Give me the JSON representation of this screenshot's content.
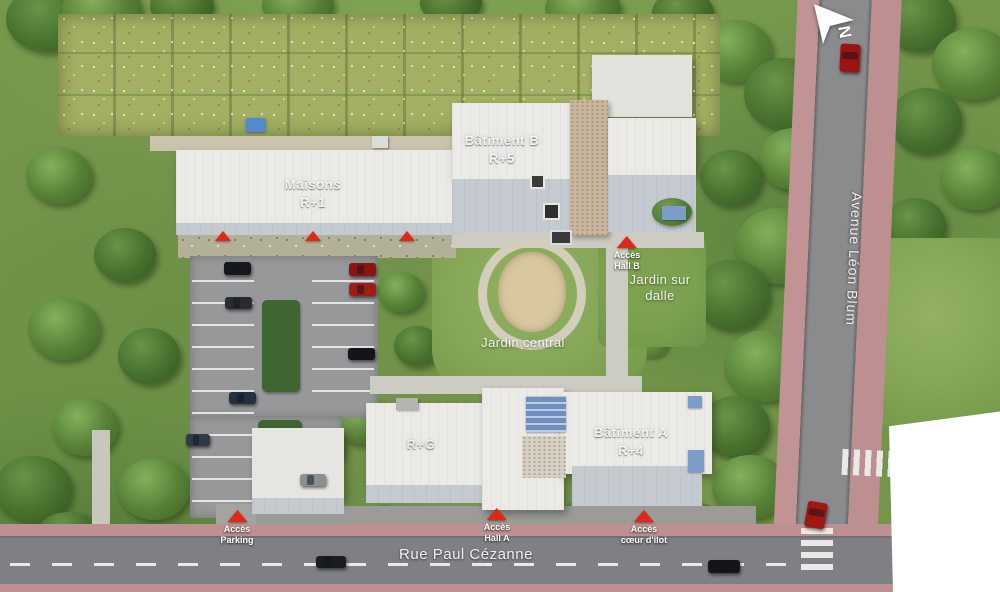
{
  "plan": {
    "buildings": {
      "maisons_name": "Maisons",
      "maisons_floors": "R+1",
      "batiment_b_name": "Bâtiment B",
      "batiment_b_floors": "R+5",
      "batiment_a_name": "Bâtiment A",
      "batiment_a_floors": "R+4",
      "wing_floors": "R+G"
    },
    "gardens": {
      "central": "Jardin central",
      "dalle_line1": "Jardin sur",
      "dalle_line2": "dalle"
    },
    "markers": {
      "hall_b": {
        "l1": "Accès",
        "l2": "Hall B"
      },
      "parking": {
        "l1": "Accès",
        "l2": "Parking"
      },
      "hall_a": {
        "l1": "Accès",
        "l2": "Hall A"
      },
      "coeur": {
        "l1": "Accès",
        "l2": "cœur d'îlot"
      }
    },
    "streets": {
      "bottom": "Rue Paul Cézanne",
      "right": "Avenue Léon Blum"
    },
    "compass": {
      "label": "N"
    },
    "colors": {
      "marker_red": "#e02818",
      "roof_white": "#ebeae7",
      "roof_gray": "#c5cad0",
      "gravel_tan": "#c8b79e",
      "road_gray": "#8a8b8d",
      "sidewalk_pink": "#c29394",
      "lawn_green": "#86a556",
      "tree_green": "#4e7c33"
    }
  }
}
